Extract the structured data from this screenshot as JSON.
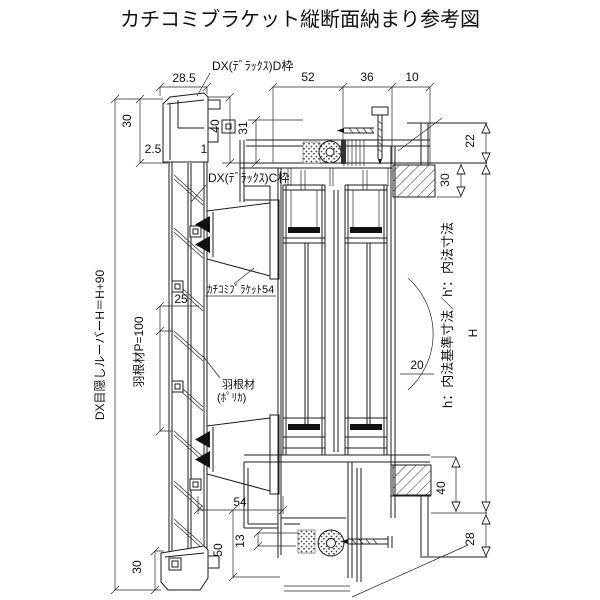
{
  "title": "カチコミブラケット縦断面納まり参考図",
  "colors": {
    "line": "#1c1c1c",
    "background": "#ffffff"
  },
  "labels": {
    "frame_d": "DX(ﾃﾞﾗｯｸｽ)D枠",
    "frame_c": "DX(ﾃﾞﾗｯｸｽ)C枠",
    "bracket": "ｶﾁｺﾐﾌﾞﾗｹｯﾄ54",
    "blade_line1": "羽根材",
    "blade_line2": "(ﾎﾟﾘｶ)",
    "blade_pitch": "羽根材P=100",
    "louver_height": "DX目隠しルーバーH＝H+90",
    "inner_dim_note": "h：内法基準寸法／h'：内法寸法",
    "overall_height": "H"
  },
  "dims": {
    "top_28_5": "28.5",
    "top_52": "52",
    "top_36": "36",
    "top_10": "10",
    "left_30": "30",
    "left_40": "40",
    "left_31": "31",
    "left_2_5": "2.5",
    "left_1": "1",
    "right_22": "22",
    "right_30": "30",
    "pitch_25": "25",
    "arc_20": "20",
    "bracket_54": "54",
    "right_40": "40",
    "right_28": "28",
    "bottom_50": "50",
    "bottom_13": "13",
    "bottom_30": "30"
  }
}
